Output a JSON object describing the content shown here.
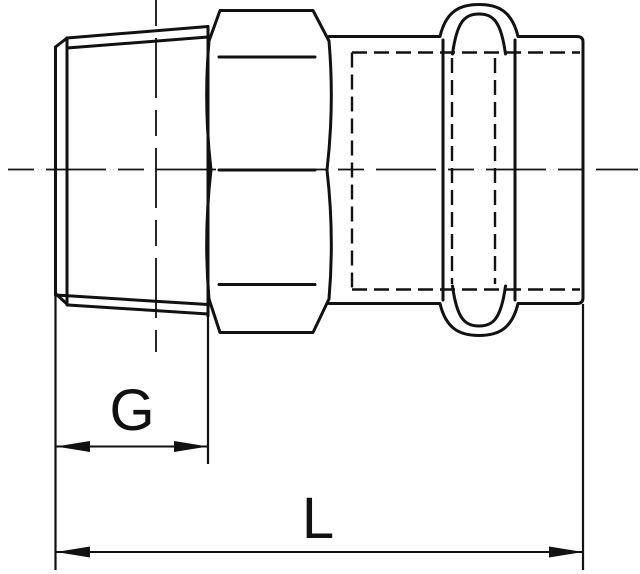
{
  "page": {
    "background_color": "#ffffff",
    "line_color": "#111111"
  },
  "drawing": {
    "kind": "technical-drawing",
    "subject": "press-fit male adapter coupling, side section view",
    "parts": {
      "left": "tapered male thread end",
      "middle": "hexagon nut body",
      "right": "press socket with o-ring bead"
    },
    "dimensions": {
      "thread_length_label": "G",
      "overall_length_label": "L"
    }
  }
}
